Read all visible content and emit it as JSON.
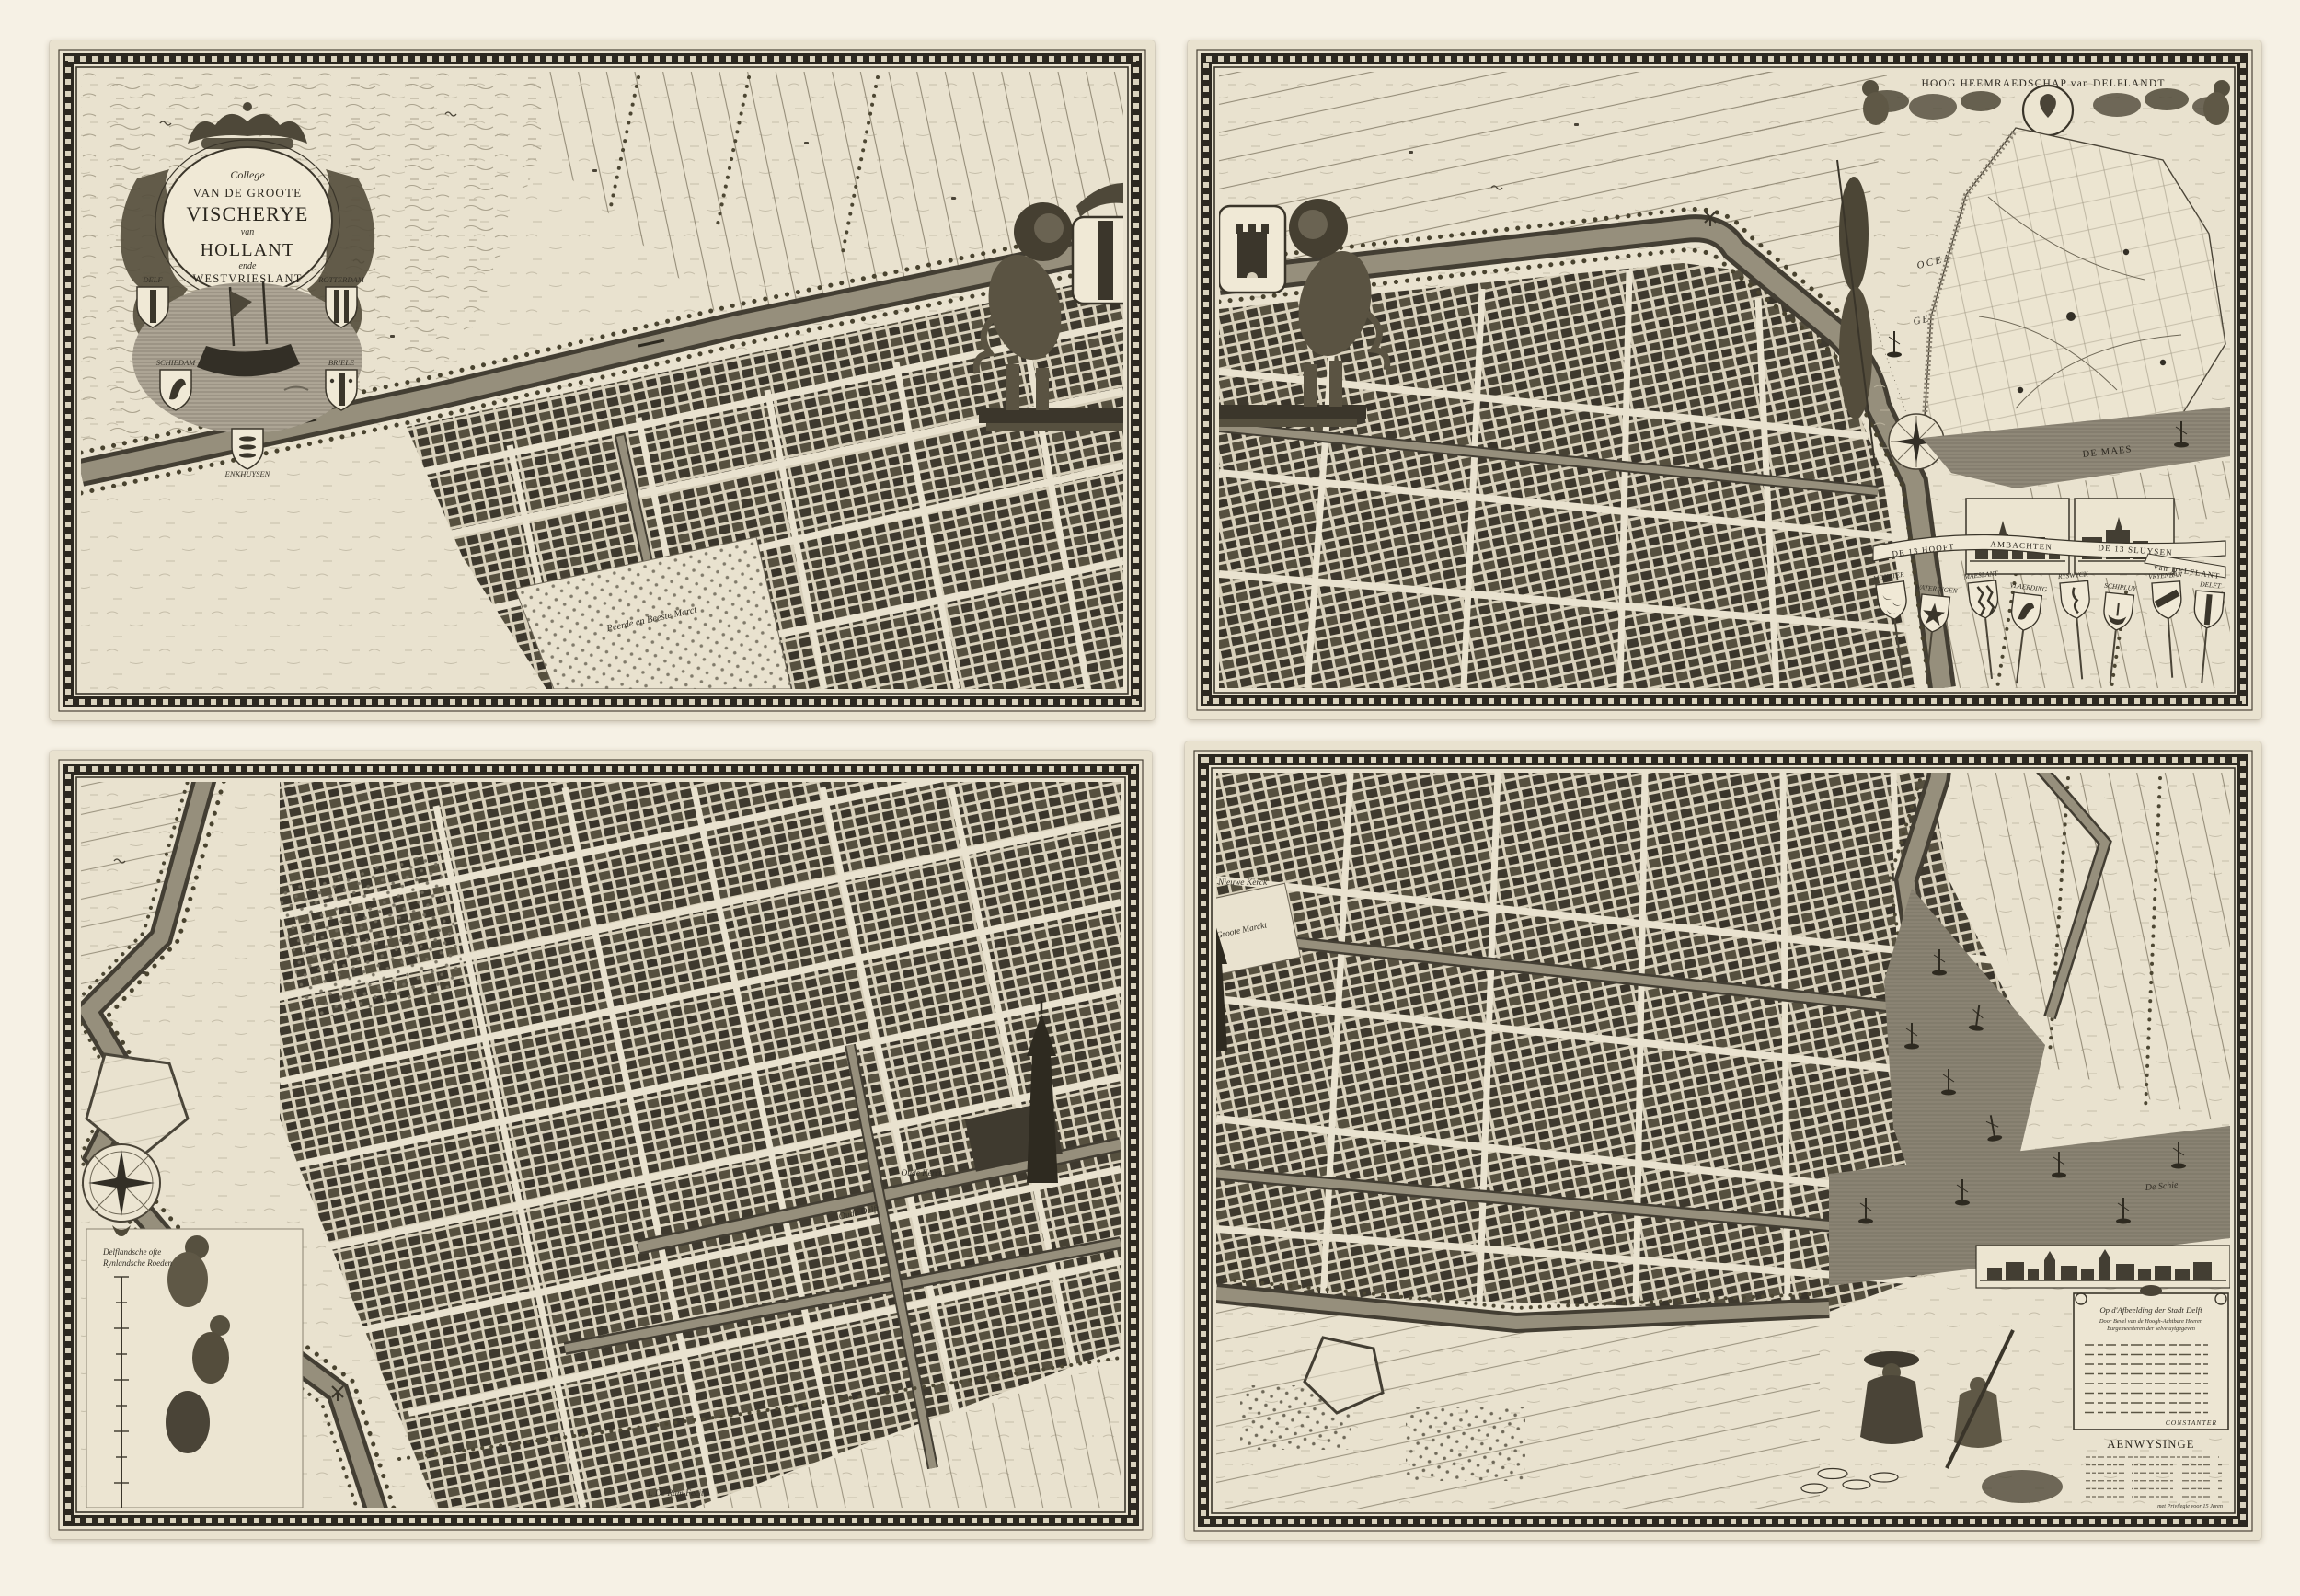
{
  "palette": {
    "page_bg": "#f6f1e5",
    "sheet_paper": "#e9e2cf",
    "ink": "#2b2820",
    "water": "#8d8676",
    "shield_paper": "#f0e9d6"
  },
  "sheet1": {
    "cartouche": {
      "l1": "College",
      "l2": "VAN DE GROOTE",
      "l3": "VISCHERYE",
      "l4": "van",
      "l5": "HOLLANT",
      "l6": "ende",
      "l7": "WESTVRIESLANT"
    },
    "shields": [
      "DELF",
      "ROTTERDAM",
      "SCHIEDAM",
      "BRIELE",
      "ENKHUYSEN"
    ],
    "market_label": "Peerde en Beeste Marct"
  },
  "sheet2": {
    "heading": "HOOG HEEMRAEDSCHAP van DELFLANDT",
    "sea_label_1": "OCEANUS",
    "sea_label_2": "GERMANICUS",
    "river_label": "DE MAES",
    "banner": [
      "DE 13 HOOFT",
      "AMBACHTEN",
      "DE 13 SLUYSEN",
      "van DELFLANT"
    ],
    "shield_labels": [
      "MONSTER",
      "WATERINGEN",
      "MAESLANT",
      "VLAERDING",
      "RYSWYCK",
      "SCHIPLUY",
      "VRYENBAN",
      "DELFT"
    ]
  },
  "sheet3": {
    "church_label": "Oude Kerck",
    "canal_label": "Oude Delft",
    "scale_label_1": "Delflandsche ofte",
    "scale_label_2": "Rynlandsche Roeden",
    "signature": "I. De Ram Fecit"
  },
  "sheet4": {
    "church_label": "Nieuwe Kerck",
    "market_label": "Groote Marckt",
    "river_label": "De Schie",
    "poem": {
      "title": "Op d'Afbeelding der Stadt Delft",
      "sub1": "Door Bevel van de Hoogh-Achtbare Heeren",
      "sub2": "Burgemeesteren der selve uytgegeven",
      "signature": "CONSTANTER"
    },
    "legend": {
      "title": "AENWYSINGE",
      "privilege": "met Privilegie voor 15 Jaren"
    }
  }
}
